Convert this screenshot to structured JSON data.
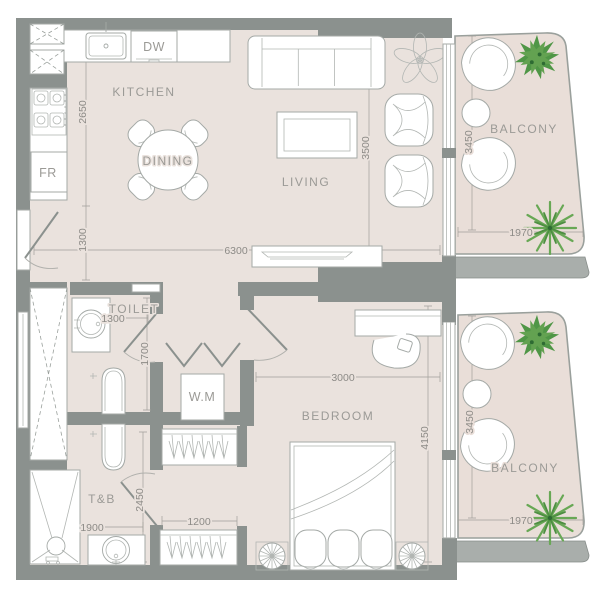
{
  "plan": {
    "rooms": {
      "kitchen": "KITCHEN",
      "dining": "DINING",
      "living": "LIVING",
      "toilet": "TOILET",
      "bedroom": "BEDROOM",
      "tb": "T&B",
      "balcony_upper": "BALCONY",
      "balcony_lower": "BALCONY"
    },
    "appliances": {
      "dw": "DW",
      "fr": "FR",
      "wm": "W.M"
    },
    "dims": {
      "kitchen_height": "2650",
      "entry_width": "1300",
      "living_width": "6300",
      "living_height": "3500",
      "balcony_upper_height": "3450",
      "balcony_upper_width": "1970",
      "toilet_width": "1300",
      "toilet_height": "1700",
      "bedroom_width": "3000",
      "bedroom_height": "4150",
      "balcony_lower_height": "3450",
      "balcony_lower_width": "1970",
      "tb_height": "2450",
      "tb_width": "1900",
      "wardrobe_width": "1200"
    },
    "colors": {
      "wall": "#8b918e",
      "slab": "#a9aeab",
      "floor": "#eae2dd",
      "balcony_floor": "#e9ded8",
      "plant_green": "#4f9646",
      "palm_green": "#68a855",
      "label_text": "#9b9a96",
      "dim_text": "#8d8b87"
    }
  }
}
